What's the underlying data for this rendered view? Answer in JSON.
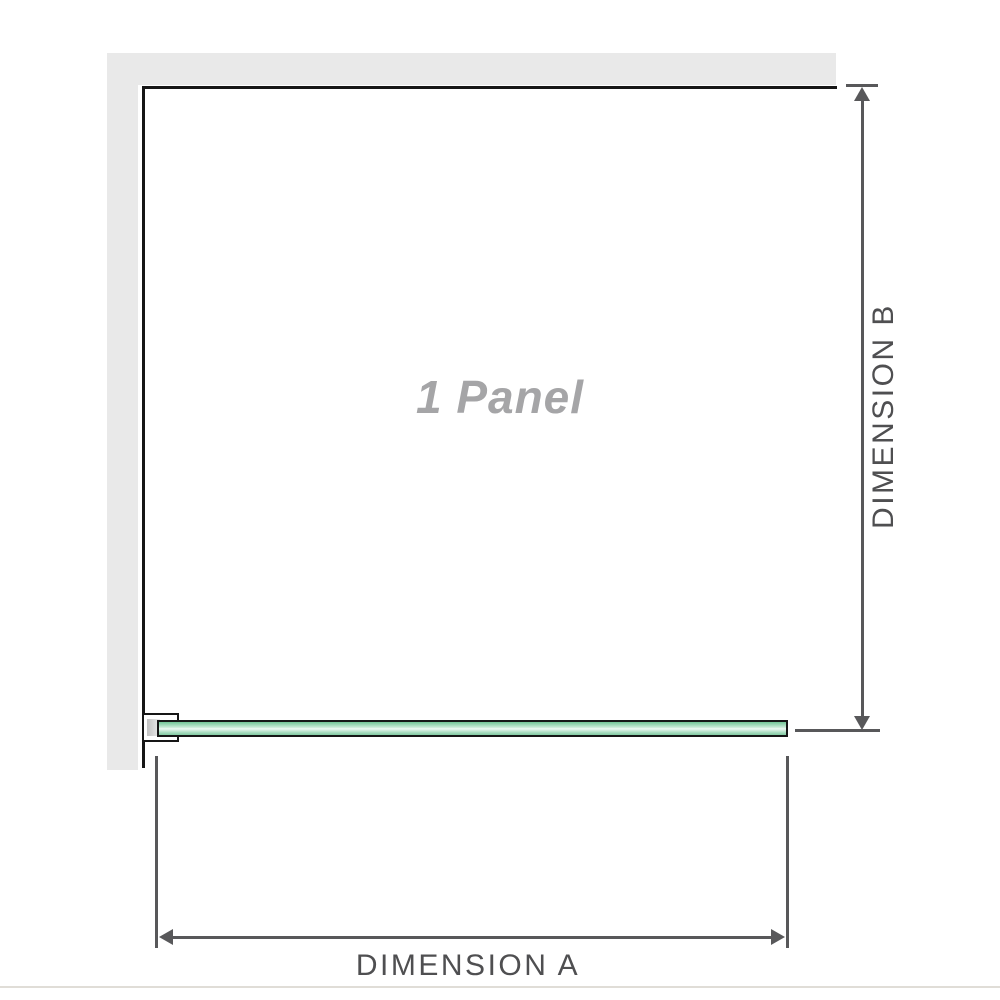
{
  "diagram": {
    "title": "1 panel shower screen dimension diagram",
    "panel_label": "1 Panel",
    "dimension_a_label": "DIMENSION A",
    "dimension_b_label": "DIMENSION B"
  },
  "colors": {
    "wall_gray": "#e9e9e9",
    "frame_outline": "#161616",
    "dimension_gray": "#58585a",
    "label_text": "#4f4f51",
    "panel_label_gray": "#a5a5a7",
    "glass_green_dark": "#72c596",
    "glass_green_light": "#eef8f3",
    "glass_green_mid": "#9ed8b8",
    "baseline_gray": "#e0ddd7"
  }
}
